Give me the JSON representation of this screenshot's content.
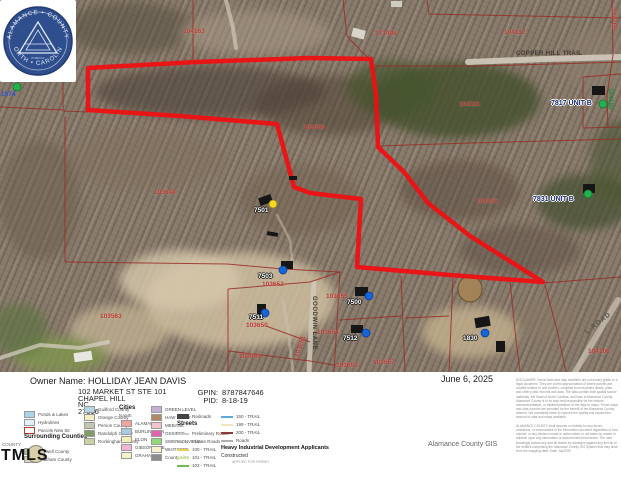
{
  "meta": {
    "date": "June 6, 2025"
  },
  "owner": {
    "label": "Owner Name:",
    "name": "HOLLIDAY JEAN DAVIS",
    "address1": "102 MARKET ST STE 101",
    "address2": "CHAPEL HILL",
    "address3": "NC",
    "address4": "27516",
    "gpin_label": "GPIN:",
    "gpin": "8787847646",
    "pid_label": "PID:",
    "pid": "8-18-19"
  },
  "branding": {
    "tmls": "TMLS",
    "gis_credit": "Alamance County GIS"
  },
  "seal": {
    "top": "ALAMANCE • COUNTY",
    "bottom": "NORTH • CAROLINA",
    "motto": "PUBLICO"
  },
  "disclaimer": {
    "para1": "DISCLAIMER: Parcel lines and map modifiers are not survey grade or a legal document. They are a best approximation of where parcels are located relative to one another, compiled from recorded deeds, plats and other public records and data. The data contain both spatial source materials, the State of North Carolina, and lines in Alamance County. Alamance County is in no way held responsible for the misuse, misrepresentation, or misinterpretation of the data or maps. These maps and data sources are provided for the benefit of the Alamance County citizens. We constantly strive to improve the quality and expand the amount of data and maps available.",
    "para2": "ALAMANCE COUNTY shall assume no liability for any errors, omissions, or inaccuracies in the information provided regardless of how caused; or any decision made or action taken or not taken by reader in reliance upon any information or data furnished hereunder. The user knowingly waives any and all claims for damages against any and all of the entities comprising the Alamance County GIS System that may arise from the mapping data. Data: July2020"
  },
  "map": {
    "colors": {
      "boundary": "#ee1013",
      "parcel_line": "#992c25",
      "marker_green": "#25b14b",
      "marker_yellow": "#ffd61f",
      "marker_blue": "#1766d8"
    },
    "boundary_points": "88,68 196,62 310,58 371,59 376,95 378,147 404,172 428,203 470,236 543,282 450,275 357,267 361,199 310,193 294,187 277,124 180,116 88,110",
    "parcel_lines": [
      "63,0 63,110",
      "0,107 63,110",
      "0,34 63,35",
      "63,111 88,112",
      "193,0 193,62",
      "343,0 347,36 362,52 373,62",
      "373,66 480,66 621,62",
      "427,0 429,14 621,18",
      "583,77 621,74",
      "583,77 583,128 621,127",
      "378,146 470,143 621,139",
      "543,283 621,277",
      "545,285 557,330 566,372",
      "65,117 65,262",
      "65,262 227,264 283,269 340,272",
      "228,289 228,372",
      "228,289 310,282 340,272",
      "228,351 310,361 334,365",
      "266,326 310,342",
      "340,272 334,372",
      "340,320 401,316",
      "401,276 405,372",
      "453,278 449,372",
      "405,318 449,316",
      "510,281 516,340 520,372",
      "612,0 613,55 607,95 608,128"
    ],
    "roads": [
      {
        "pts": "468,62 545,59 621,57",
        "w": 6,
        "c": "#d2cabc",
        "o": 0.9
      },
      {
        "pts": "226,0 233,28 236,48",
        "w": 4,
        "c": "#cfc7ba",
        "o": 0.7
      },
      {
        "pts": "314,283 311,330 309,372",
        "w": 5,
        "c": "#d2cabc",
        "o": 0.8
      },
      {
        "pts": "575,372 600,330 618,300",
        "w": 6,
        "c": "#cfc8bb",
        "o": 0.7
      },
      {
        "pts": "0,358 40,345 80,348 108,342",
        "w": 4,
        "c": "#d8d2c6",
        "o": 0.7
      },
      {
        "pts": "293,372 288,330 283,300",
        "w": 3,
        "c": "#cbc2b2",
        "o": 0.5
      },
      {
        "pts": "277,215 290,240 293,270",
        "w": 2.5,
        "c": "#c8bfae",
        "o": 0.5
      }
    ],
    "blobs": [
      {
        "cx": 130,
        "cy": 28,
        "rx": 65,
        "ry": 26,
        "f": "#57503f",
        "o": 0.55
      },
      {
        "cx": 25,
        "cy": 45,
        "rx": 28,
        "ry": 32,
        "f": "#403d2f",
        "o": 0.6
      },
      {
        "cx": 255,
        "cy": 33,
        "rx": 75,
        "ry": 22,
        "f": "#a99b85",
        "o": 0.5
      },
      {
        "cx": 210,
        "cy": 92,
        "rx": 115,
        "ry": 26,
        "f": "#4c4135",
        "o": 0.6
      },
      {
        "cx": 330,
        "cy": 105,
        "rx": 75,
        "ry": 30,
        "f": "#514437",
        "o": 0.55
      },
      {
        "cx": 455,
        "cy": 100,
        "rx": 85,
        "ry": 38,
        "f": "#42502c",
        "o": 0.8
      },
      {
        "cx": 392,
        "cy": 88,
        "rx": 45,
        "ry": 28,
        "f": "#46542e",
        "o": 0.7
      },
      {
        "cx": 585,
        "cy": 202,
        "rx": 48,
        "ry": 28,
        "f": "#42502c",
        "o": 0.7
      },
      {
        "cx": 620,
        "cy": 160,
        "rx": 30,
        "ry": 40,
        "f": "#4a5631",
        "o": 0.6
      },
      {
        "cx": 460,
        "cy": 190,
        "rx": 60,
        "ry": 30,
        "f": "#5a4c3c",
        "o": 0.5
      },
      {
        "cx": 300,
        "cy": 200,
        "rx": 60,
        "ry": 35,
        "f": "#6e5d4a",
        "o": 0.45
      },
      {
        "cx": 145,
        "cy": 160,
        "rx": 80,
        "ry": 30,
        "f": "#7d6e5b",
        "o": 0.4
      },
      {
        "cx": 40,
        "cy": 200,
        "rx": 40,
        "ry": 60,
        "f": "#6a5c4b",
        "o": 0.5
      },
      {
        "cx": 600,
        "cy": 60,
        "rx": 40,
        "ry": 30,
        "f": "#8d7f6e",
        "o": 0.5
      },
      {
        "cx": 520,
        "cy": 250,
        "rx": 60,
        "ry": 25,
        "f": "#5c5040",
        "o": 0.5
      },
      {
        "cx": 240,
        "cy": 300,
        "rx": 95,
        "ry": 48,
        "f": "#cdbd9f",
        "o": 0.85
      },
      {
        "cx": 180,
        "cy": 280,
        "rx": 60,
        "ry": 30,
        "f": "#d6c8ab",
        "o": 0.8
      },
      {
        "cx": 120,
        "cy": 330,
        "rx": 50,
        "ry": 25,
        "f": "#c8b897",
        "o": 0.7
      },
      {
        "cx": 470,
        "cy": 332,
        "rx": 48,
        "ry": 26,
        "f": "#c3b08d",
        "o": 0.8
      },
      {
        "cx": 545,
        "cy": 320,
        "rx": 30,
        "ry": 20,
        "f": "#8a7a62",
        "o": 0.5
      },
      {
        "cx": 60,
        "cy": 355,
        "rx": 48,
        "ry": 18,
        "f": "#7f9450",
        "o": 0.85
      },
      {
        "cx": 18,
        "cy": 330,
        "rx": 30,
        "ry": 26,
        "f": "#5e7442",
        "o": 0.7
      }
    ],
    "pond": {
      "cx": 470,
      "cy": 289,
      "rx": 12,
      "ry": 13,
      "f": "#a18357",
      "s": "#63512f"
    },
    "houses": [
      {
        "x": 259,
        "y": 196,
        "w": 13,
        "h": 8,
        "r": -20
      },
      {
        "x": 267,
        "y": 232,
        "w": 11,
        "h": 4,
        "r": 10
      },
      {
        "x": 289,
        "y": 176,
        "w": 8,
        "h": 4,
        "r": 0
      },
      {
        "x": 281,
        "y": 261,
        "w": 12,
        "h": 8,
        "r": 0
      },
      {
        "x": 257,
        "y": 304,
        "w": 9,
        "h": 11,
        "r": 0
      },
      {
        "x": 355,
        "y": 287,
        "w": 13,
        "h": 9,
        "r": 0
      },
      {
        "x": 351,
        "y": 325,
        "w": 12,
        "h": 8,
        "r": 0
      },
      {
        "x": 475,
        "y": 317,
        "w": 15,
        "h": 10,
        "r": -10
      },
      {
        "x": 496,
        "y": 341,
        "w": 9,
        "h": 11,
        "r": 0
      },
      {
        "x": 592,
        "y": 86,
        "w": 13,
        "h": 9,
        "r": 0
      },
      {
        "x": 583,
        "y": 184,
        "w": 12,
        "h": 9,
        "r": 0
      },
      {
        "x": 352,
        "y": 29,
        "w": 13,
        "h": 9,
        "r": 15,
        "f": "#d8d4cc"
      },
      {
        "x": 391,
        "y": 1,
        "w": 11,
        "h": 6,
        "r": 0,
        "f": "#cfccc4"
      },
      {
        "x": 74,
        "y": 352,
        "w": 18,
        "h": 9,
        "r": -8,
        "f": "#e8e6e0"
      },
      {
        "x": 24,
        "y": 70,
        "w": 8,
        "h": 9,
        "r": 0,
        "f": "#3a5fa8"
      }
    ],
    "markers": [
      {
        "x": 17,
        "y": 87,
        "c": "green"
      },
      {
        "x": 603,
        "y": 104,
        "c": "green"
      },
      {
        "x": 588,
        "y": 194,
        "c": "green"
      },
      {
        "x": 273,
        "y": 204,
        "c": "yellow"
      },
      {
        "x": 283,
        "y": 270,
        "c": "blue"
      },
      {
        "x": 265,
        "y": 313,
        "c": "blue"
      },
      {
        "x": 369,
        "y": 296,
        "c": "blue"
      },
      {
        "x": 366,
        "y": 333,
        "c": "blue"
      },
      {
        "x": 485,
        "y": 333,
        "c": "blue"
      }
    ],
    "labels": [
      {
        "t": "100116",
        "x": 16,
        "y": -4,
        "s": "parcel"
      },
      {
        "t": "100117",
        "x": 20,
        "y": 53,
        "s": "parcel"
      },
      {
        "t": "1574",
        "x": 1,
        "y": 91,
        "s": "blue"
      },
      {
        "t": "104163",
        "x": 183,
        "y": 28,
        "s": "parcel"
      },
      {
        "t": "171498",
        "x": 375,
        "y": 30,
        "s": "parcel"
      },
      {
        "t": "104112",
        "x": 504,
        "y": 29,
        "s": "parcel"
      },
      {
        "t": "132765",
        "x": 617,
        "y": 8,
        "s": "parcel",
        "r": 90
      },
      {
        "t": "COPPER HILL TRAIL",
        "x": 516,
        "y": 51,
        "s": "road"
      },
      {
        "t": "104111",
        "x": 459,
        "y": 101,
        "s": "parcel"
      },
      {
        "t": "7817 UNIT B",
        "x": 551,
        "y": 100,
        "s": "unit"
      },
      {
        "t": "104150",
        "x": 614,
        "y": 88,
        "s": "green",
        "r": 90
      },
      {
        "t": "103656",
        "x": 303,
        "y": 124,
        "s": "parcel"
      },
      {
        "t": "103648",
        "x": 154,
        "y": 189,
        "s": "parcel"
      },
      {
        "t": "104105",
        "x": 476,
        "y": 198,
        "s": "parcel"
      },
      {
        "t": "7831 UNIT B",
        "x": 533,
        "y": 196,
        "s": "unit"
      },
      {
        "t": "7501",
        "x": 254,
        "y": 207,
        "s": "halo"
      },
      {
        "t": "7503",
        "x": 258,
        "y": 273,
        "s": "halo"
      },
      {
        "t": "103652",
        "x": 262,
        "y": 281,
        "s": "parcel"
      },
      {
        "t": "103563",
        "x": 100,
        "y": 313,
        "s": "parcel"
      },
      {
        "t": "7511",
        "x": 249,
        "y": 314,
        "s": "halo"
      },
      {
        "t": "103650",
        "x": 246,
        "y": 322,
        "s": "parcel"
      },
      {
        "t": "103655",
        "x": 326,
        "y": 293,
        "s": "parcel"
      },
      {
        "t": "7500",
        "x": 347,
        "y": 299,
        "s": "halo"
      },
      {
        "t": "GOODWIN LANE",
        "x": 317,
        "y": 296,
        "s": "roadv",
        "r": 90
      },
      {
        "t": "103654",
        "x": 317,
        "y": 329,
        "s": "parcel"
      },
      {
        "t": "7512",
        "x": 343,
        "y": 335,
        "s": "halo"
      },
      {
        "t": "1830",
        "x": 463,
        "y": 335,
        "s": "halo"
      },
      {
        "t": "103649",
        "x": 239,
        "y": 353,
        "s": "parcel"
      },
      {
        "t": "103651",
        "x": 294,
        "y": 356,
        "s": "parcel",
        "r": -73
      },
      {
        "t": "103653",
        "x": 336,
        "y": 362,
        "s": "parcel"
      },
      {
        "t": "103657",
        "x": 373,
        "y": 359,
        "s": "parcel"
      },
      {
        "t": "L ROAD",
        "x": 584,
        "y": 330,
        "s": "roadgray",
        "r": -38
      },
      {
        "t": "104106",
        "x": 588,
        "y": 348,
        "s": "parcel"
      }
    ]
  },
  "legend": {
    "entries": [
      {
        "k": "f",
        "x": 24,
        "y": 411,
        "c": "#a9d3e9",
        "label": "Ponds & Lakes"
      },
      {
        "k": "f",
        "x": 24,
        "y": 419,
        "c": "#e4f1f7",
        "label": "Hydrolines"
      },
      {
        "k": "f",
        "x": 24,
        "y": 427,
        "c": "#ffffff",
        "b": "#c0392b",
        "label": "Parcels New 50"
      },
      {
        "k": "h",
        "x": 24,
        "y": 434,
        "label": "Surrounding Counties"
      },
      {
        "k": "s",
        "x": 2,
        "y": 442,
        "label": "COUNTY"
      },
      {
        "k": "f",
        "x": 24,
        "y": 448,
        "c": "#a3c585",
        "label": "Caswell County"
      },
      {
        "k": "f",
        "x": 24,
        "y": 456,
        "c": "#d9d2a8",
        "label": "Chatham County"
      },
      {
        "k": "f",
        "x": 84,
        "y": 406,
        "c": "#b5d6e8",
        "label": "Guilford County"
      },
      {
        "k": "f",
        "x": 84,
        "y": 414,
        "c": "#f2ecbf",
        "label": "Orange County"
      },
      {
        "k": "f",
        "x": 84,
        "y": 422,
        "c": "#c2c7b2",
        "label": "Person County"
      },
      {
        "k": "f",
        "x": 84,
        "y": 430,
        "c": "#7f9e66",
        "label": "Randolph County"
      },
      {
        "k": "f",
        "x": 84,
        "y": 438,
        "c": "#cdd1a2",
        "label": "Rockingham County"
      },
      {
        "k": "h",
        "x": 119,
        "y": 405,
        "label": "Cities"
      },
      {
        "k": "s",
        "x": 119,
        "y": 413,
        "label": "NAME"
      },
      {
        "k": "f",
        "x": 121,
        "y": 420,
        "c": "#f2a39b",
        "label": "ALAMANCE"
      },
      {
        "k": "f",
        "x": 121,
        "y": 428,
        "c": "#a9cbe2",
        "label": "BURLINGTON"
      },
      {
        "k": "f",
        "x": 121,
        "y": 436,
        "c": "#f5efb5",
        "label": "ELON"
      },
      {
        "k": "f",
        "x": 121,
        "y": 444,
        "c": "#f2b6d3",
        "label": "GIBSONVILLE"
      },
      {
        "k": "f",
        "x": 121,
        "y": 452,
        "c": "#f7f2c9",
        "label": "GRAHAM"
      },
      {
        "k": "f",
        "x": 151,
        "y": 406,
        "c": "#c5afd9",
        "label": "GREEN LEVEL"
      },
      {
        "k": "f",
        "x": 151,
        "y": 414,
        "c": "#b28a67",
        "label": "HAW RIVER"
      },
      {
        "k": "f",
        "x": 151,
        "y": 422,
        "c": "#f2c3cb",
        "label": "MEBANE"
      },
      {
        "k": "f",
        "x": 151,
        "y": 430,
        "c": "#e264ab",
        "label": "OSSIPEE"
      },
      {
        "k": "f",
        "x": 151,
        "y": 438,
        "c": "#93da7a",
        "label": "SWEPSONVILLE"
      },
      {
        "k": "f",
        "x": 151,
        "y": 446,
        "c": "#f7f2c9",
        "label": "WHITSETT"
      },
      {
        "k": "f",
        "x": 151,
        "y": 454,
        "c": "#8c8c8c",
        "label": "County Line"
      },
      {
        "k": "l",
        "x": 177,
        "y": 414,
        "c": "#444444",
        "rail": true,
        "label": "Railroads"
      },
      {
        "k": "h",
        "x": 177,
        "y": 421,
        "label": "Streets"
      },
      {
        "k": "l",
        "x": 177,
        "y": 431,
        "c": "#c9c9c9",
        "label": "Preliminary Roads"
      },
      {
        "k": "l",
        "x": 177,
        "y": 439,
        "c": "#a8a8a8",
        "dash": true,
        "label": "Private Roads"
      },
      {
        "k": "l",
        "x": 177,
        "y": 447,
        "c": "#e3d34e",
        "label": "100 - TRAIL"
      },
      {
        "k": "l",
        "x": 177,
        "y": 455,
        "c": "#cfe6a2",
        "label": "101 - TRAIL"
      },
      {
        "k": "l",
        "x": 177,
        "y": 463,
        "c": "#6dbf4e",
        "label": "102 - TRAIL"
      },
      {
        "k": "l",
        "x": 221,
        "y": 414,
        "c": "#58a9dc",
        "label": "150 - TRAIL"
      },
      {
        "k": "l",
        "x": 221,
        "y": 422,
        "c": "#efe6c0",
        "label": "199 - TRAIL"
      },
      {
        "k": "l",
        "x": 221,
        "y": 430,
        "c": "#8c3a3a",
        "label": "200 - TRAIL"
      },
      {
        "k": "l",
        "x": 221,
        "y": 438,
        "c": "#b0b0b0",
        "label": "Roads"
      },
      {
        "k": "h2",
        "x": 221,
        "y": 445,
        "label": "Heavy Industrial Development Applicants"
      },
      {
        "k": "s2",
        "x": 221,
        "y": 453,
        "label": "Constructed"
      },
      {
        "k": "t",
        "x": 232,
        "y": 460,
        "label": "APPLIED FOR PERMIT"
      }
    ]
  }
}
